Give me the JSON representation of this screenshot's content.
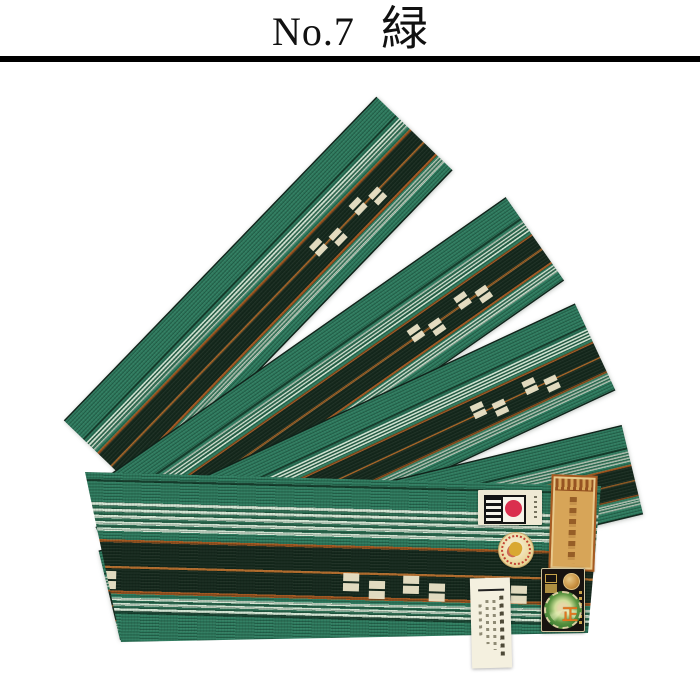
{
  "header": {
    "number": "No.7",
    "color_name": "緑"
  },
  "photo": {
    "subject": "obi-belts-fanned",
    "belt_count": 5,
    "seal_character": "正",
    "colors": {
      "belt_green": "#2e7c5f",
      "belt_dark_band": "#16291d",
      "stripe_pale_mint": "#d4e6d4",
      "stripe_orange": "#a2561f",
      "motif_cream": "#ece4c8",
      "label_gold": "#d7a558",
      "label_black": "#181310",
      "seal_red": "#da2f4e",
      "green_seal": "#3f7d35"
    },
    "labels": [
      {
        "name": "hakata-mark-label",
        "text_legible": false
      },
      {
        "name": "gold-woven-label",
        "text_legible": false
      },
      {
        "name": "round-certification-sticker",
        "text_legible": false
      },
      {
        "name": "black-certification-label",
        "text_legible": false
      },
      {
        "name": "green-seal-sticker",
        "text_legible": false
      },
      {
        "name": "paper-price-tag",
        "text_legible": false
      }
    ]
  }
}
